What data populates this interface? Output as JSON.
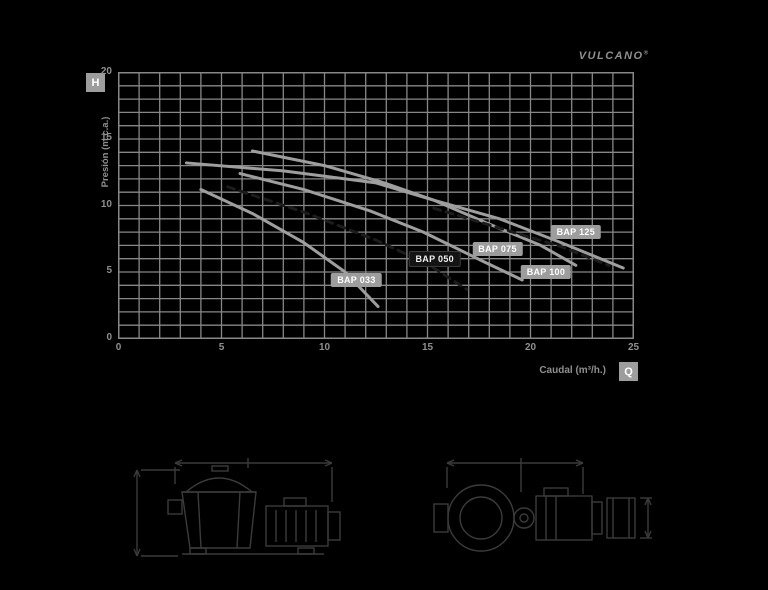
{
  "brand": {
    "logo_text": "VULCANO",
    "registered": "®"
  },
  "colors": {
    "background": "#000000",
    "grid": "#878787",
    "curve": "#9e9e9e",
    "dashed_curve": "#1c1c1c",
    "pill_bg": "#9d9d9d",
    "pill_text": "#ffffff",
    "dark_pill_bg": "#141414",
    "axis_text": "#8f8f8f",
    "drawing": "#3b3b3b"
  },
  "chart_data": {
    "type": "line",
    "title": "",
    "xlabel": "Caudal (m³/h.)",
    "ylabel": "Presión (m.c.a.)",
    "x_axis_symbol": "Q",
    "y_axis_symbol": "H",
    "xlim": [
      0,
      25
    ],
    "ylim": [
      0,
      20
    ],
    "x_ticks": [
      0,
      5,
      10,
      15,
      20,
      25
    ],
    "y_ticks": [
      0,
      5,
      10,
      15,
      20
    ],
    "grid": "on",
    "grid_step": {
      "x": 1,
      "y": 1
    },
    "legend_position": "labels-on-curves",
    "series": [
      {
        "name": "BAP 033",
        "style": "solid",
        "points": [
          [
            4.0,
            11.2
          ],
          [
            6.5,
            9.4
          ],
          [
            9.0,
            7.2
          ],
          [
            11.0,
            5.0
          ],
          [
            12.6,
            2.4
          ]
        ],
        "label_pos": [
          11.55,
          4.4
        ],
        "label_theme": "gray"
      },
      {
        "name": "BAP 050",
        "style": "dashed",
        "points": [
          [
            5.3,
            11.4
          ],
          [
            9.0,
            9.5
          ],
          [
            12.5,
            7.4
          ],
          [
            15.0,
            5.6
          ],
          [
            16.9,
            3.7
          ]
        ],
        "label_pos": [
          15.35,
          6.0
        ],
        "label_theme": "dark"
      },
      {
        "name": "BAP 075",
        "style": "solid",
        "points": [
          [
            5.9,
            12.4
          ],
          [
            9.0,
            11.2
          ],
          [
            12.2,
            9.6
          ],
          [
            14.8,
            8.0
          ],
          [
            17.7,
            5.8
          ],
          [
            19.6,
            4.4
          ]
        ],
        "label_pos": [
          18.4,
          6.7
        ],
        "label_theme": "gray"
      },
      {
        "name": "BAP 100",
        "style": "solid",
        "points": [
          [
            3.3,
            13.2
          ],
          [
            8.0,
            12.6
          ],
          [
            12.5,
            11.7
          ],
          [
            15.3,
            10.4
          ],
          [
            18.0,
            8.6
          ],
          [
            20.5,
            7.0
          ],
          [
            22.2,
            5.5
          ]
        ],
        "label_pos": [
          20.75,
          5.0
        ],
        "label_theme": "gray"
      },
      {
        "name": "BAP 125",
        "style": "solid",
        "points": [
          [
            6.5,
            14.1
          ],
          [
            10.0,
            13.0
          ],
          [
            12.9,
            11.7
          ],
          [
            15.3,
            10.4
          ],
          [
            18.5,
            9.0
          ],
          [
            21.5,
            7.2
          ],
          [
            24.5,
            5.3
          ]
        ],
        "label_pos": [
          22.2,
          8.0
        ],
        "label_theme": "gray"
      },
      {
        "name": "",
        "style": "dashed",
        "points": [
          [
            15.3,
            9.8
          ],
          [
            18.5,
            8.3
          ],
          [
            21.5,
            6.9
          ],
          [
            23.8,
            5.5
          ]
        ],
        "label_pos": null,
        "label_theme": null
      }
    ]
  }
}
